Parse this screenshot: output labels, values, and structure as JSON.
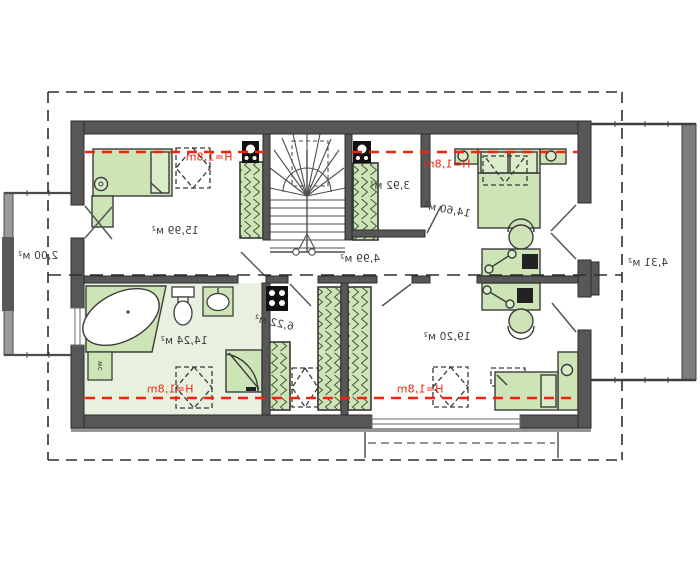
{
  "plan": {
    "type": "attic-floor-plan-mirrored",
    "rooms": [
      {
        "id": "room-top-left",
        "area_label": "15,99 м²"
      },
      {
        "id": "closet-top",
        "area_label": "3,92 м²"
      },
      {
        "id": "bedroom-top-right",
        "area_label": "14,60 м²"
      },
      {
        "id": "hallway",
        "area_label": "4,99 м²"
      },
      {
        "id": "bathroom",
        "area_label": "14,24 м²"
      },
      {
        "id": "closet-bottom",
        "area_label": "6,22 м²"
      },
      {
        "id": "bedroom-bottom-right",
        "area_label": "19,20 м²"
      },
      {
        "id": "balcony-left",
        "area_label": "2,00 м²"
      },
      {
        "id": "balcony-right",
        "area_label": "4,31 м²"
      }
    ],
    "height_line_label": "H=1,8m",
    "fixture_labels": {
      "washer": "wc"
    },
    "colors": {
      "wall": "#575757",
      "furniture_green": "#cde4b6",
      "bathroom_floor": "#e8f1df",
      "height_line_red": "#f2230f",
      "outline": "#2d2d2d"
    }
  }
}
